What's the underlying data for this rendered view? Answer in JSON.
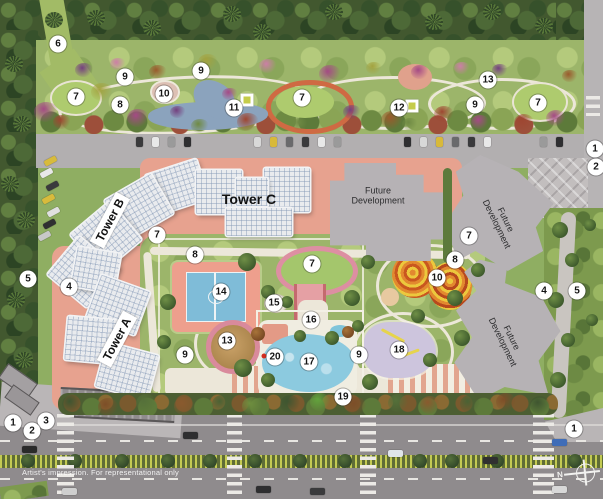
{
  "plan": {
    "disclaimer": "Artist's impression. For representational only",
    "compass": {
      "label": "N"
    },
    "tower_labels": [
      {
        "id": "tower-a",
        "text": "Tower A"
      },
      {
        "id": "tower-b",
        "text": "Tower B"
      },
      {
        "id": "tower-c",
        "text": "Tower C"
      }
    ],
    "future_development_labels": [
      {
        "id": "future-development-center",
        "text": "Future Development"
      },
      {
        "id": "future-development-north-east",
        "text": "Future Development"
      },
      {
        "id": "future-development-south-east",
        "text": "Future Development"
      }
    ],
    "markers": [
      {
        "n": "6",
        "x": 58,
        "y": 44
      },
      {
        "n": "9",
        "x": 201,
        "y": 71
      },
      {
        "n": "9",
        "x": 125,
        "y": 77
      },
      {
        "n": "13",
        "x": 488,
        "y": 80
      },
      {
        "n": "10",
        "x": 164,
        "y": 94
      },
      {
        "n": "7",
        "x": 76,
        "y": 97
      },
      {
        "n": "7",
        "x": 302,
        "y": 98
      },
      {
        "n": "7",
        "x": 538,
        "y": 103
      },
      {
        "n": "8",
        "x": 120,
        "y": 105
      },
      {
        "n": "9",
        "x": 475,
        "y": 105
      },
      {
        "n": "11",
        "x": 234,
        "y": 108
      },
      {
        "n": "12",
        "x": 399,
        "y": 108
      },
      {
        "n": "1",
        "x": 595,
        "y": 149
      },
      {
        "n": "2",
        "x": 596,
        "y": 167
      },
      {
        "n": "7",
        "x": 157,
        "y": 235
      },
      {
        "n": "7",
        "x": 469,
        "y": 236
      },
      {
        "n": "8",
        "x": 195,
        "y": 255
      },
      {
        "n": "8",
        "x": 455,
        "y": 260
      },
      {
        "n": "7",
        "x": 312,
        "y": 264
      },
      {
        "n": "10",
        "x": 437,
        "y": 278
      },
      {
        "n": "5",
        "x": 28,
        "y": 279
      },
      {
        "n": "4",
        "x": 69,
        "y": 287
      },
      {
        "n": "4",
        "x": 544,
        "y": 291
      },
      {
        "n": "5",
        "x": 577,
        "y": 291
      },
      {
        "n": "14",
        "x": 221,
        "y": 292
      },
      {
        "n": "15",
        "x": 274,
        "y": 303
      },
      {
        "n": "16",
        "x": 311,
        "y": 320
      },
      {
        "n": "13",
        "x": 227,
        "y": 341
      },
      {
        "n": "18",
        "x": 399,
        "y": 350
      },
      {
        "n": "9",
        "x": 185,
        "y": 355
      },
      {
        "n": "9",
        "x": 359,
        "y": 355
      },
      {
        "n": "20",
        "x": 275,
        "y": 357
      },
      {
        "n": "17",
        "x": 309,
        "y": 362
      },
      {
        "n": "19",
        "x": 343,
        "y": 397
      },
      {
        "n": "3",
        "x": 46,
        "y": 421
      },
      {
        "n": "1",
        "x": 13,
        "y": 423
      },
      {
        "n": "1",
        "x": 574,
        "y": 429
      },
      {
        "n": "2",
        "x": 32,
        "y": 431
      }
    ],
    "features": [
      {
        "type": "square",
        "x": 247,
        "y": 100
      },
      {
        "type": "square",
        "x": 412,
        "y": 106
      },
      {
        "type": "red-dot",
        "x": 264,
        "y": 356
      }
    ]
  },
  "colors": {
    "marker_bg": "#ffffff",
    "marker_text": "#141414",
    "building_white": "#e9ebee",
    "future_dev_gray": "#b6b2b5",
    "salmon_hardscape": "#e7a28f",
    "pool_blue": "#86c8de",
    "court_blue": "#7fbcd8",
    "lawn_green": "#a9c274",
    "road_gray": "#8f8b8d"
  }
}
